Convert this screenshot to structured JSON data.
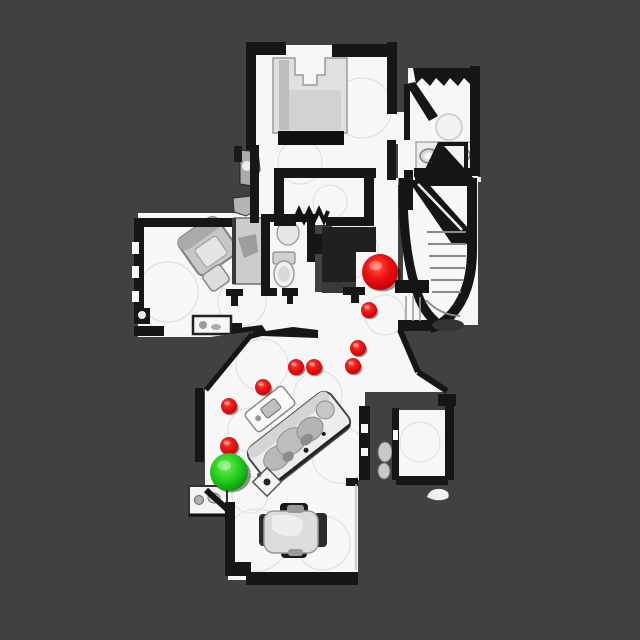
{
  "scene": {
    "background_color": "#414141",
    "floor_color": "#f7f7f7",
    "wall_color": "#161616",
    "furniture_color": "#d9d9d9",
    "scanline_color": "#dddddd"
  },
  "markers": {
    "start": {
      "name": "start-position",
      "color": "#28c828",
      "x": 229,
      "y": 472,
      "r": 19
    },
    "goal": {
      "name": "goal-position",
      "color": "#ee1111",
      "x": 380,
      "y": 272,
      "r": 18
    },
    "waypoint_color": "#ee1111",
    "waypoints": [
      {
        "x": 369,
        "y": 310,
        "r": 8
      },
      {
        "x": 358,
        "y": 348,
        "r": 8
      },
      {
        "x": 353,
        "y": 366,
        "r": 8
      },
      {
        "x": 314,
        "y": 367,
        "r": 8
      },
      {
        "x": 296,
        "y": 367,
        "r": 8
      },
      {
        "x": 263,
        "y": 387,
        "r": 8
      },
      {
        "x": 229,
        "y": 406,
        "r": 8
      },
      {
        "x": 229,
        "y": 446,
        "r": 9
      }
    ]
  }
}
